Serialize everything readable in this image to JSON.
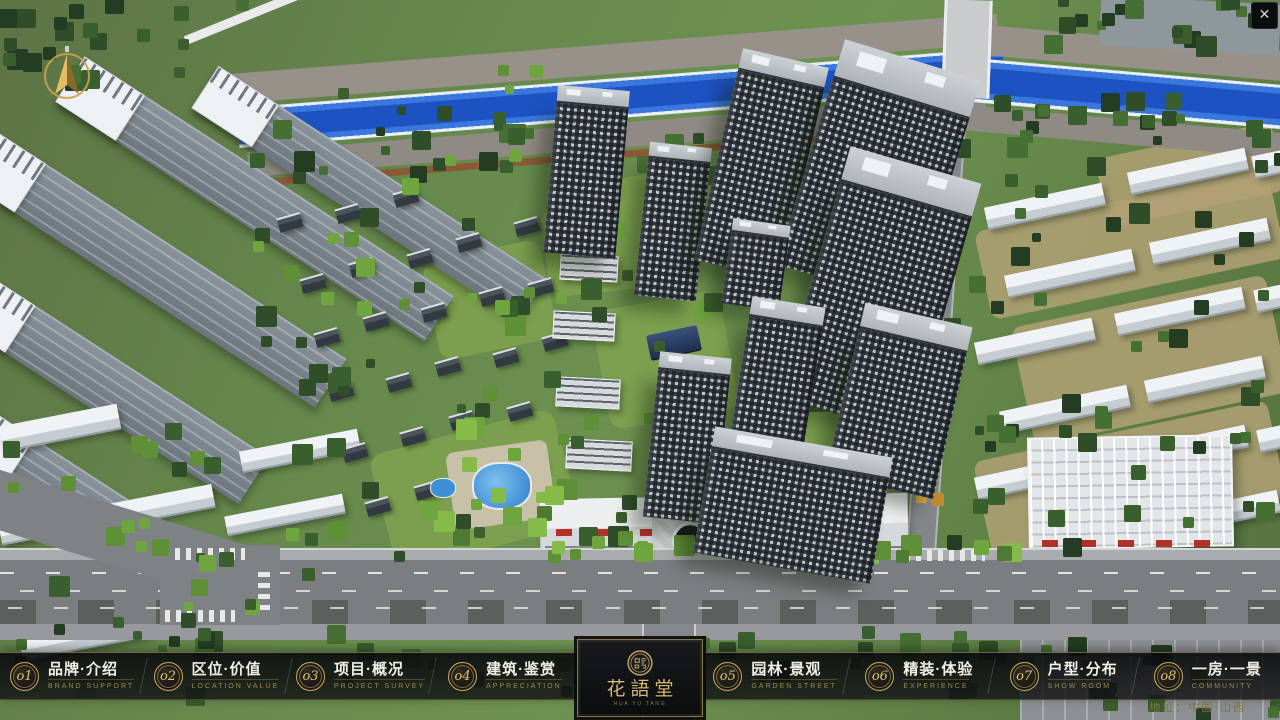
{
  "window": {
    "close_glyph": "✕"
  },
  "nav": {
    "items": [
      {
        "num": "o1",
        "zh": "品牌·介绍",
        "en": "BRAND SUPPORT"
      },
      {
        "num": "o2",
        "zh": "区位·价值",
        "en": "LOCATION VALUE"
      },
      {
        "num": "o3",
        "zh": "项目·概况",
        "en": "PROJECT SURVEY"
      },
      {
        "num": "o4",
        "zh": "建筑·鉴赏",
        "en": "APPRECIATION"
      },
      {
        "num": "o5",
        "zh": "园林·景观",
        "en": "GARDEN STREET"
      },
      {
        "num": "o6",
        "zh": "精装·体验",
        "en": "EXPERIENCE"
      },
      {
        "num": "o7",
        "zh": "户型·分布",
        "en": "SHOW ROOM"
      },
      {
        "num": "o8",
        "zh": "一房·一景",
        "en": "COMMUNITY"
      }
    ]
  },
  "logo": {
    "zh": "花語堂",
    "en": "HUA YU TANG"
  },
  "footer": {
    "address": "地址：中国·山西"
  },
  "colors": {
    "gold_accent": "#c9ab62",
    "bar_background": "#0c0e10",
    "river_blue": "#1c52c2",
    "grass_green": "#66884c",
    "road_gray": "#7b7e81",
    "awning_red": "#b23028"
  }
}
